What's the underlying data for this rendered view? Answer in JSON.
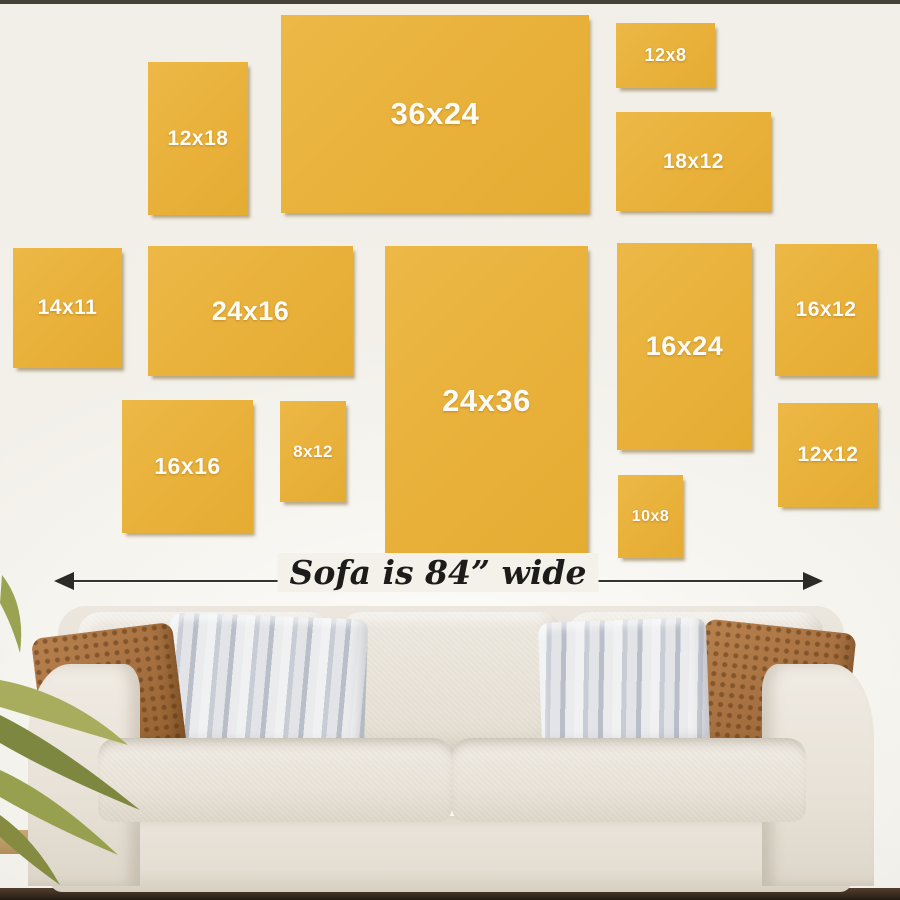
{
  "scene": {
    "description": "wall art size guide above sofa",
    "caption": "Sofa is 84” wide",
    "frames": [
      {
        "label": "12x18"
      },
      {
        "label": "36x24"
      },
      {
        "label": "12x8"
      },
      {
        "label": "18x12"
      },
      {
        "label": "14x11"
      },
      {
        "label": "24x16"
      },
      {
        "label": "24x36"
      },
      {
        "label": "16x24"
      },
      {
        "label": "16x12"
      },
      {
        "label": "16x16"
      },
      {
        "label": "8x12"
      },
      {
        "label": "10x8"
      },
      {
        "label": "12x12"
      }
    ],
    "colors": {
      "frame_fill": "#e9b23c",
      "frame_shadow": "#7d5e23",
      "frame_label": "#fdfbf6",
      "wall": "#f1efe8",
      "arrow": "#2c2a26",
      "caption_text": "#1d1c1a",
      "sofa_fabric": "#e8e2d8",
      "pillow_brown": "#a87242",
      "pillow_stripe_light": "#eff1f2",
      "pillow_stripe_dark": "#b9bec9",
      "floor_dark": "#2e2218",
      "floor_wood": "#b08e5c",
      "plant_green": "#96a04f"
    }
  }
}
